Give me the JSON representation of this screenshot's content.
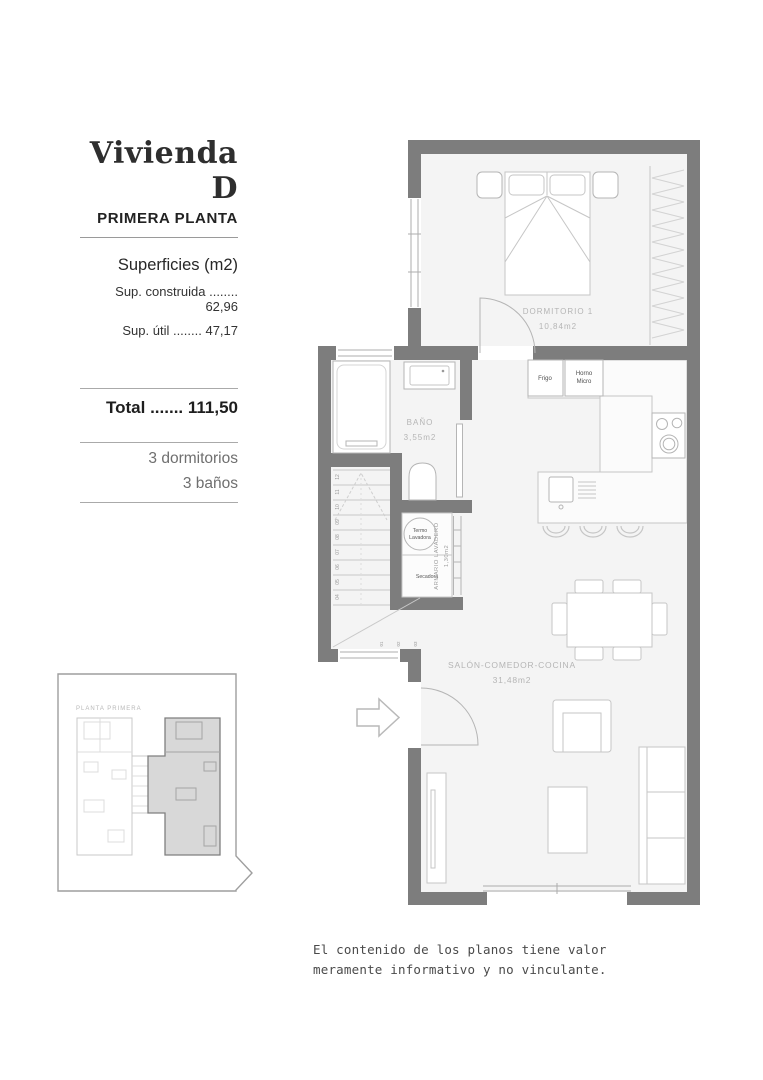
{
  "title_block": {
    "title": "Vivienda D",
    "subtitle": "PRIMERA PLANTA",
    "surfaces_heading": "Superficies (m2)",
    "rows": [
      "Sup. construida ........ 62,96",
      "Sup. útil ........ 47,17"
    ],
    "total": "Total ....... 111,50",
    "features": [
      "3 dormitorios",
      "3 baños"
    ]
  },
  "plan": {
    "dormitorio": {
      "name": "DORMITORIO 1",
      "area": "10,84m2"
    },
    "bano": {
      "name": "BAÑO",
      "area": "3,55m2"
    },
    "armario": {
      "name": "ARMARIO LAVADERO",
      "area": "1,30m2"
    },
    "salon": {
      "name": "SALÓN-COMEDOR-COCINA",
      "area": "31,48m2"
    },
    "appliances": {
      "frigo": "Frigo",
      "horno_line1": "Horno",
      "horno_line2": "Micro",
      "termo_line1": "Termo",
      "termo_line2": "Lavadora",
      "secadora": "Secadora"
    },
    "stairs": {
      "steps": [
        "12",
        "11",
        "10",
        "09",
        "08",
        "07",
        "06",
        "05",
        "04"
      ],
      "winders": [
        "01",
        "02",
        "03"
      ]
    }
  },
  "inset": {
    "label": "PLANTA PRIMERA"
  },
  "disclaimer": {
    "line1": "El contenido de los planos tiene valor",
    "line2": "meramente informativo y no vinculante."
  },
  "colors": {
    "wall": "#7d7d7d",
    "floor": "#f4f4f4",
    "inset_highlight": "#d8d8d8"
  }
}
